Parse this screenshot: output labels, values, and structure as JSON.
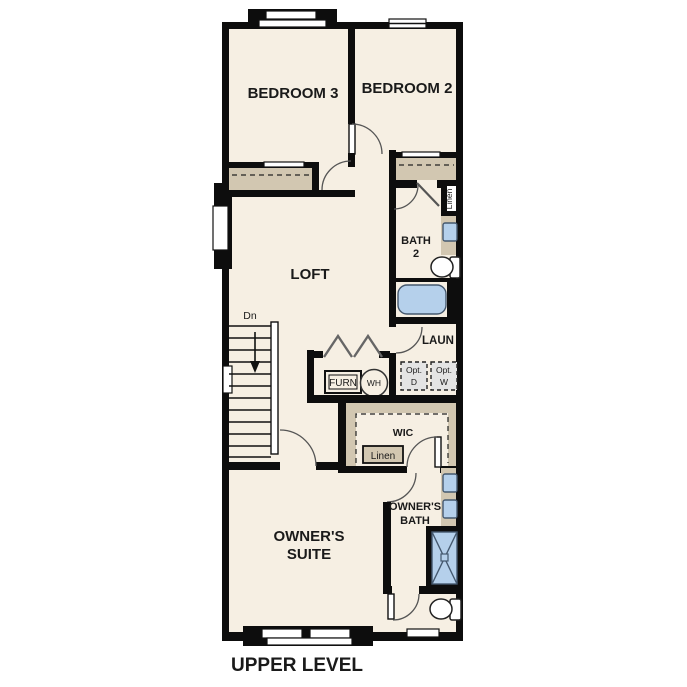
{
  "plan_title": "UPPER LEVEL",
  "rooms": {
    "bedroom3": "BEDROOM 3",
    "bedroom2": "BEDROOM 2",
    "loft": "LOFT",
    "bath2": [
      "BATH",
      "2"
    ],
    "laundry": "LAUN",
    "wic": "WIC",
    "owners_suite": [
      "OWNER'S",
      "SUITE"
    ],
    "owners_bath": [
      "OWNER'S",
      "BATH"
    ]
  },
  "fixtures": {
    "furnace": "FURN",
    "water_heater": "WH",
    "optional_dryer": [
      "Opt.",
      "D"
    ],
    "optional_washer": [
      "Opt.",
      "W"
    ],
    "linen_bath2": "Linen",
    "linen_wic": "Linen",
    "stairs_direction": "Dn"
  },
  "colors": {
    "floor": "#f6efe3",
    "wall": "#0d0d0d",
    "closet_tan": "#d2c7b1",
    "fixture_blue": "#b5d0eb",
    "optional_gray": "#e4e4e4"
  }
}
